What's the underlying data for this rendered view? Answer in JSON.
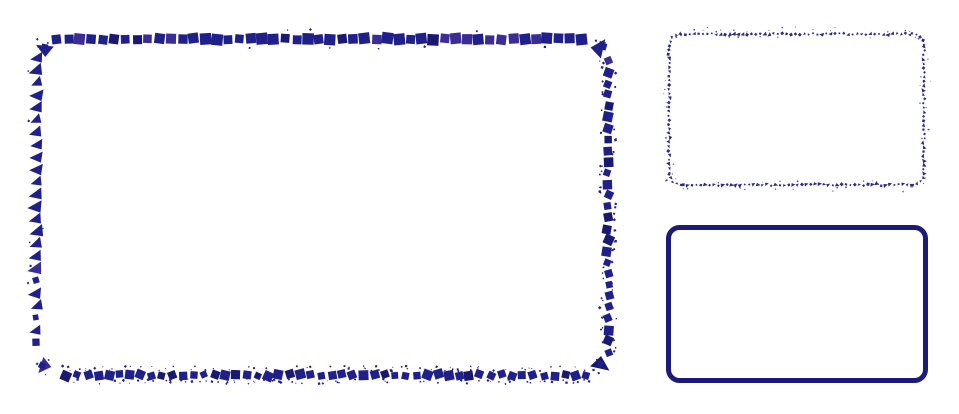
{
  "canvas": {
    "width": 959,
    "height": 414,
    "background": "#ffffff"
  },
  "illustration": {
    "title": "Rounded rectangle mosaic icon set",
    "shapes": {
      "large_mosaic": {
        "label": "large rounded rectangle built from mosaic fragments",
        "left": 36,
        "top": 39,
        "right": 608,
        "bottom": 375,
        "corner_radius": 20,
        "color": "#20208a",
        "color_dark": "#191970",
        "color_accent": "#3c2c96",
        "top_edge": {
          "tile": 10.0,
          "step": 11.4,
          "style": "square-row"
        },
        "right_edge": {
          "tile": 8.0,
          "step": 11.2,
          "style": "square-scatter"
        },
        "bottom_edge": {
          "tile": 8.0,
          "step": 10.6,
          "style": "square-dust"
        },
        "left_edge": {
          "tile": 11.0,
          "step": 12.4,
          "style": "triangle-column"
        }
      },
      "small_speckle": {
        "label": "small rounded rectangle traced with tiny speckles",
        "left": 669,
        "top": 34,
        "right": 924,
        "bottom": 185,
        "corner_radius": 12,
        "step": 4.4,
        "color": "#2b2b84"
      },
      "small_solid": {
        "label": "small rounded rectangle with solid border",
        "left": 666,
        "top": 225,
        "right": 928,
        "bottom": 383,
        "corner_radius": 11,
        "border_width": 5,
        "color": "#1c1c78"
      }
    }
  }
}
